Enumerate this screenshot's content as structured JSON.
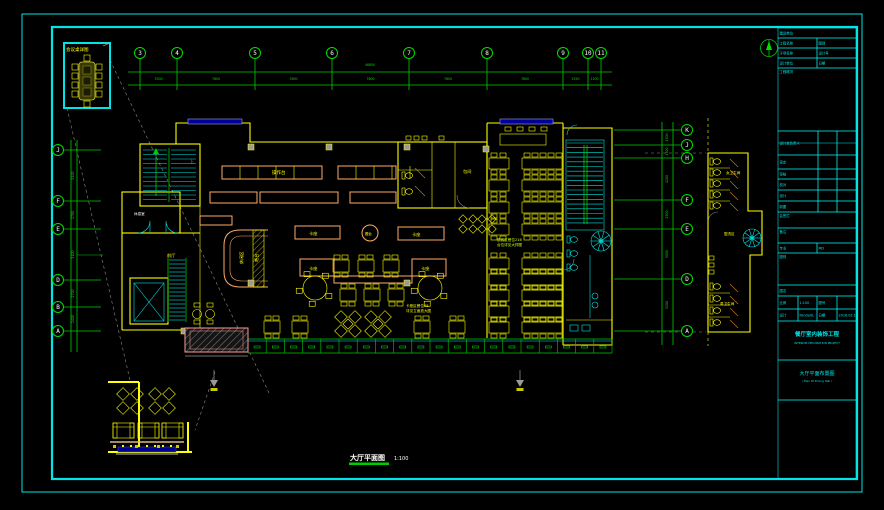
{
  "sheet": {
    "bg": "#000000",
    "frame_color": "#00e5e5"
  },
  "drawing_title": {
    "text": "大厅平面图",
    "scale": "1:100"
  },
  "conference_detail": {
    "title": "会议桌详图"
  },
  "grid": {
    "top": {
      "labels": [
        "3",
        "4",
        "5",
        "6",
        "7",
        "8",
        "9",
        "10",
        "11"
      ],
      "dims": [
        "3300",
        "7800",
        "7800",
        "7800",
        "7800",
        "7800",
        "2550",
        "1200"
      ],
      "overall": "46800"
    },
    "left": {
      "labels": [
        "J",
        "F",
        "E",
        "D",
        "B",
        "A"
      ],
      "dims": [
        "5100",
        "2700",
        "5100",
        "2700",
        "2400"
      ]
    },
    "right": {
      "labels": [
        "K",
        "J",
        "H",
        "F",
        "E",
        "D",
        "A"
      ],
      "dims": [
        "1500",
        "1300",
        "4200",
        "2900",
        "5000",
        "5200"
      ]
    }
  },
  "plan_labels": {
    "counter": "操作台",
    "bar": "吧台",
    "lounge": "休闲区",
    "booth": "卡座",
    "round_table": "圆台",
    "lobby": "前厅",
    "rest_room": "休息室",
    "private_room": "包间",
    "up": "上"
  },
  "notes": {
    "dining_1": "散客区餐位216",
    "dining_2": "台位详见大样图",
    "booth_1": "卡座区餐位48",
    "booth_2": "详见立面放大图"
  },
  "toilet_detail": {
    "female": "女卫生间",
    "wash": "盥洗区",
    "male": "男卫生间"
  },
  "titleblock": {
    "unit": "建设单位",
    "project": "工程名称",
    "category": "图别",
    "subitem": "子项名称",
    "design_no": "设计号",
    "firm": "设计单位",
    "date1": "日期",
    "overview": "工程概况",
    "chief": "设计总负责人",
    "approve": "审定",
    "check": "审核",
    "proof": "校对",
    "design": "设计",
    "draft": "制图",
    "countersign": "会签栏",
    "remark": "备注",
    "major_label": "专业",
    "major_value": "MD",
    "type_label": "图别",
    "name_header": "图名",
    "scale_label": "比例",
    "scale_value": "1:100",
    "sheet_label": "图号",
    "sheet_value": "",
    "design2_label": "设计",
    "design2_value": "PandaXL",
    "date2_label": "日期",
    "date2_value": "2016.02.18",
    "project_title": "餐厅室内装饰工程",
    "project_title_en": "INTERIOR DECORATION PROJECT",
    "sheet_title": "大厅平面布置图",
    "sheet_title_en": "( Plan Of Dining Hall )"
  }
}
